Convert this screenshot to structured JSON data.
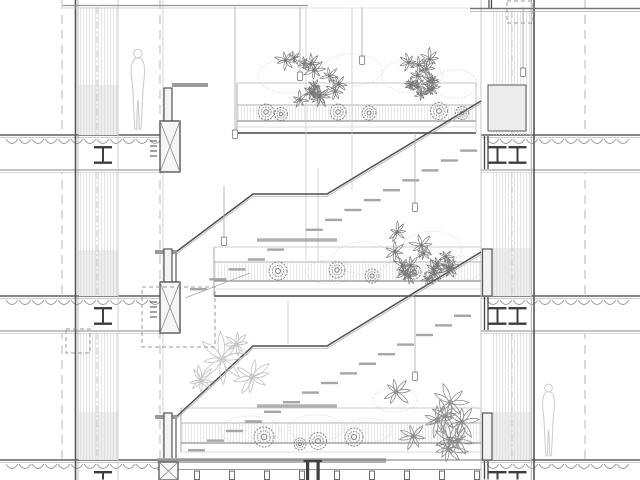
{
  "meta": {
    "type": "architectural-section-drawing"
  },
  "palette": {
    "bg": "#ffffff",
    "cut": "#4f4f4f",
    "dark": "#3f3f3f",
    "mid": "#8a8a8a",
    "light": "#c6c6c6",
    "hatch": "#dcdcdc",
    "shade": "#ededed",
    "tread": "#a6a6a6",
    "bar": "#b0b0b0",
    "plant_dark": "#787878",
    "plant_mid": "#8c8c8c",
    "plant_light": "#c6c6c6",
    "faint": "#e4e4e4",
    "figure": "#cfcfcf",
    "dashline": "#bdbdbd"
  },
  "drawing": {
    "w": 640,
    "h": 480,
    "grid_lines": [
      {
        "x": 62
      },
      {
        "x": 160
      },
      {
        "x": 585
      }
    ],
    "ceiling": {
      "left": [
        63,
        308,
        5.5,
        8
      ],
      "faint": [
        308,
        470,
        8
      ],
      "right": [
        470,
        640,
        8.5,
        11.5
      ]
    },
    "left_wall": {
      "outer": [
        [
          75.5,
          1.6
        ],
        [
          78,
          0.7
        ]
      ],
      "inner_x": 118,
      "gallery_x": 163,
      "hatch": [
        79,
        118
      ],
      "center_x": 97,
      "segments": [
        [
          7,
          135
        ],
        [
          172,
          296
        ],
        [
          333,
          460
        ]
      ],
      "shades": [
        [
          79,
          85,
          39,
          50
        ],
        [
          79,
          250,
          39,
          46
        ],
        [
          79,
          412,
          39,
          48
        ]
      ]
    },
    "right_wall": {
      "outer": [
        [
          531.5,
          0.7
        ],
        [
          534,
          1.6
        ]
      ],
      "inner_x": 481,
      "hatch": [
        492,
        531
      ],
      "center_x": 512,
      "segments": [
        [
          11,
          135
        ],
        [
          172,
          296
        ],
        [
          333,
          460
        ]
      ],
      "shades": [
        [
          492,
          248,
          39,
          48
        ],
        [
          492,
          412,
          39,
          48
        ]
      ],
      "panel": [
        488,
        85,
        38,
        46
      ],
      "members": [
        [
          482.5,
          249,
          9.5,
          47
        ],
        [
          482.5,
          413,
          9.5,
          47
        ]
      ],
      "plate_levels": [
        135,
        296,
        460
      ],
      "top_stub_x": [
        489,
        491.5
      ]
    },
    "slab_const": {
      "thick": 37,
      "deck_step": 13
    },
    "slabs": [
      {
        "x0": 0,
        "x1": 163,
        "T": 135,
        "beams": [
          103
        ],
        "partial": false
      },
      {
        "x0": 0,
        "x1": 163,
        "T": 296,
        "beams": [
          103
        ],
        "partial": false
      },
      {
        "x0": 0,
        "x1": 163,
        "T": 460,
        "beams": [
          103
        ],
        "partial": true
      },
      {
        "x0": 481,
        "x1": 640,
        "T": 135,
        "beams": [
          497.5,
          517.5
        ],
        "partial": false
      },
      {
        "x0": 481,
        "x1": 640,
        "T": 296,
        "beams": [
          497.5,
          517.5
        ],
        "partial": false
      },
      {
        "x0": 481,
        "x1": 640,
        "T": 460,
        "beams": [
          497.5,
          517.5
        ],
        "partial": true
      }
    ],
    "mullions_left": [
      {
        "T": 135,
        "xbox": true
      },
      {
        "T": 296,
        "xbox": true
      },
      {
        "T": 460,
        "xbox": false
      }
    ],
    "stairs": [
      {
        "stub": {
          "x": 155,
          "w": 22,
          "y": 250
        },
        "post": {
          "x": 176,
          "y0": 252,
          "y1": 296
        },
        "rail": [
          [
            176,
            252
          ],
          [
            253,
            194
          ],
          [
            327,
            194
          ],
          [
            481,
            101
          ]
        ],
        "bar": {
          "x0": 257,
          "x1": 337,
          "y": 240
        },
        "treads": {
          "x0": 190,
          "y0": 288,
          "dx": 19.3,
          "dy": -9.9,
          "n": 15
        }
      },
      {
        "stub": {
          "x": 155,
          "w": 22,
          "y": 415
        },
        "post": {
          "x": 176,
          "y0": 417,
          "y1": 460
        },
        "rail": [
          [
            176,
            417
          ],
          [
            253,
            346
          ],
          [
            327,
            346
          ],
          [
            481,
            252
          ]
        ],
        "bar": {
          "x0": 257,
          "x1": 337,
          "y": 406
        },
        "treads": {
          "x0": 188,
          "y0": 449,
          "dx": 19,
          "dy": -9.6,
          "n": 15
        }
      }
    ],
    "gallery_stub": {
      "x": 172,
      "w": 36,
      "y": 83
    },
    "hangers": [
      [
        306,
        7,
        260
      ],
      [
        352,
        7,
        190
      ],
      [
        318,
        168,
        262
      ],
      [
        288,
        300,
        344
      ]
    ],
    "pendants": [
      {
        "x": 235,
        "y0": 7,
        "y1": 130
      },
      {
        "x": 300,
        "y0": 7,
        "y1": 72
      },
      {
        "x": 362,
        "y0": 7,
        "y1": 56
      },
      {
        "x": 523,
        "y0": 7,
        "y1": 68
      },
      {
        "x": 224,
        "y0": 186,
        "y1": 237
      },
      {
        "x": 415,
        "y0": 133,
        "y1": 203
      },
      {
        "x": 415,
        "y0": 297,
        "y1": 372
      }
    ],
    "bands": [
      {
        "x0": 237,
        "x1": 476,
        "lines": [
          {
            "y": 83,
            "c": "#c4c4c4",
            "w": 1
          },
          {
            "y": 105,
            "c": "#b2b2b2",
            "w": 1
          },
          {
            "y": 121,
            "c": "#909090",
            "w": 1.2
          },
          {
            "y": 127,
            "c": "#d2d2d2",
            "w": 0.8
          },
          {
            "y": 133,
            "c": "#5f5f5f",
            "w": 1.7
          }
        ],
        "hatch": [
          106,
          120
        ],
        "bushes": [
          {
            "x": 266,
            "y": 112,
            "r": 8
          },
          {
            "x": 281,
            "y": 114,
            "r": 6.5
          },
          {
            "x": 338,
            "y": 112,
            "r": 8
          },
          {
            "x": 369,
            "y": 113,
            "r": 7
          },
          {
            "x": 439,
            "y": 111,
            "r": 8.5
          },
          {
            "x": 462,
            "y": 113,
            "r": 6.5
          }
        ]
      },
      {
        "x0": 214,
        "x1": 481,
        "lines": [
          {
            "y": 247,
            "c": "#cccccc",
            "w": 1
          },
          {
            "y": 262,
            "c": "#b2b2b2",
            "w": 1
          },
          {
            "y": 281,
            "c": "#909090",
            "w": 1.2
          },
          {
            "y": 289,
            "c": "#d2d2d2",
            "w": 0.8
          },
          {
            "y": 296,
            "c": "#5f5f5f",
            "w": 1.7
          }
        ],
        "hatch": [
          263,
          280
        ],
        "bushes": [
          {
            "x": 278,
            "y": 271,
            "r": 9
          },
          {
            "x": 337,
            "y": 270,
            "r": 8
          },
          {
            "x": 372,
            "y": 276,
            "r": 7
          },
          {
            "x": 414,
            "y": 272,
            "r": 7
          }
        ]
      },
      {
        "x0": 181,
        "x1": 481,
        "lines": [
          {
            "y": 408,
            "c": "#cccccc",
            "w": 1
          },
          {
            "y": 423,
            "c": "#b2b2b2",
            "w": 1
          },
          {
            "y": 443,
            "c": "#909090",
            "w": 1.2
          },
          {
            "y": 452,
            "c": "#d2d2d2",
            "w": 0.8
          }
        ],
        "hatch": [
          424,
          442
        ],
        "bushes": [
          {
            "x": 264,
            "y": 437,
            "r": 10
          },
          {
            "x": 318,
            "y": 441,
            "r": 8.5
          },
          {
            "x": 354,
            "y": 437,
            "r": 9
          },
          {
            "x": 300,
            "y": 444,
            "r": 6
          }
        ]
      }
    ],
    "clusters": [
      {
        "cx": 312,
        "cy": 79,
        "rx": 33,
        "ry": 26,
        "n": 14,
        "rmin": 5,
        "rmax": 10,
        "petals": 7,
        "color": "#787878",
        "lw": 0.7,
        "seed": 7
      },
      {
        "cx": 429,
        "cy": 80,
        "rx": 31,
        "ry": 26,
        "n": 13,
        "rmin": 5,
        "rmax": 10,
        "petals": 7,
        "color": "#787878",
        "lw": 0.7,
        "seed": 11
      },
      {
        "cx": 424,
        "cy": 254,
        "rx": 40,
        "ry": 31,
        "n": 16,
        "rmin": 6,
        "rmax": 11,
        "petals": 7,
        "color": "#787878",
        "lw": 0.7,
        "seed": 23
      },
      {
        "cx": 436,
        "cy": 420,
        "rx": 50,
        "ry": 36,
        "n": 9,
        "rmin": 12,
        "rmax": 18,
        "petals": 7,
        "color": "#8c8c8c",
        "lw": 0.8,
        "seed": 31
      }
    ],
    "daisies": [
      {
        "x": 222,
        "y": 359,
        "r": 23
      },
      {
        "x": 252,
        "y": 377,
        "r": 18
      },
      {
        "x": 201,
        "y": 381,
        "r": 14
      },
      {
        "x": 237,
        "y": 344,
        "r": 11
      }
    ],
    "faint_blobs": [
      {
        "cx": 288,
        "cy": 76,
        "rx": 30,
        "ry": 17
      },
      {
        "cx": 352,
        "cy": 70,
        "rx": 30,
        "ry": 16
      },
      {
        "cx": 412,
        "cy": 76,
        "rx": 30,
        "ry": 17
      },
      {
        "cx": 455,
        "cy": 84,
        "rx": 22,
        "ry": 14
      },
      {
        "cx": 362,
        "cy": 258,
        "rx": 28,
        "ry": 16
      },
      {
        "cx": 432,
        "cy": 248,
        "rx": 30,
        "ry": 17
      },
      {
        "cx": 464,
        "cy": 268,
        "rx": 18,
        "ry": 12
      },
      {
        "cx": 330,
        "cy": 272,
        "rx": 24,
        "ry": 12
      },
      {
        "cx": 250,
        "cy": 430,
        "rx": 30,
        "ry": 14
      },
      {
        "cx": 316,
        "cy": 428,
        "rx": 28,
        "ry": 13
      },
      {
        "cx": 368,
        "cy": 430,
        "rx": 24,
        "ry": 12
      },
      {
        "cx": 470,
        "cy": 420,
        "rx": 14,
        "ry": 14
      },
      {
        "cx": 395,
        "cy": 400,
        "rx": 22,
        "ry": 12
      }
    ],
    "figures": [
      {
        "x": 125,
        "y": 48,
        "h": 86
      },
      {
        "x": 537,
        "y": 383,
        "h": 77
      }
    ],
    "callouts": [
      [
        142,
        287,
        73,
        60
      ],
      [
        66,
        329,
        24,
        24
      ],
      [
        507,
        1,
        26,
        22
      ]
    ],
    "leader": [
      185,
      298,
      250,
      273
    ],
    "bottom": {
      "bar": [
        157,
        458,
        229,
        5
      ],
      "floor_line": [
        157,
        481,
        460
      ],
      "post_line": [
        157,
        481,
        469.5
      ],
      "posts": {
        "x0": 197,
        "step": 35,
        "n": 9,
        "y": 471,
        "w": 5,
        "h": 8.5
      },
      "pair_x": [
        306,
        316.5
      ],
      "xbox": [
        159,
        462,
        19,
        18
      ]
    }
  }
}
